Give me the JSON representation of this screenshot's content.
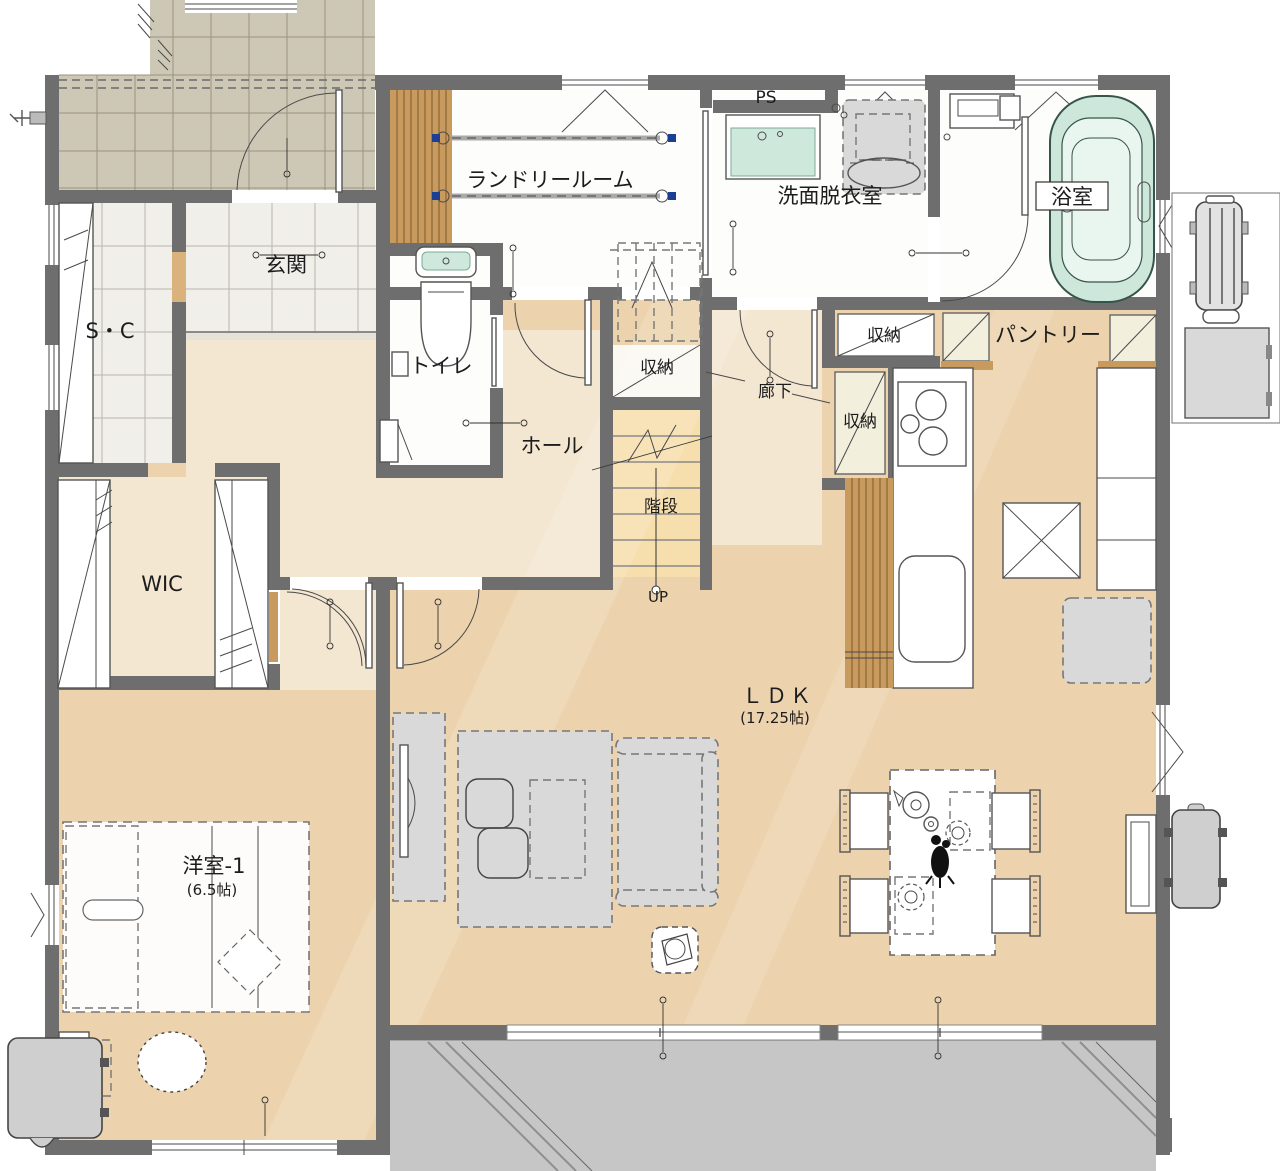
{
  "plan": {
    "type": "floor_plan_1f",
    "rooms": {
      "laundry": "ランドリールーム",
      "pipe_space": "PS",
      "washroom": "洗面脱衣室",
      "bathroom": "浴室",
      "entrance": "玄関",
      "shoe_closet": "S・C",
      "toilet": "トイレ",
      "storage_stairs": "収納",
      "storage_upper": "収納",
      "storage_corridor": "収納",
      "corridor": "廊下",
      "pantry": "パントリー",
      "hall": "ホール",
      "stairs": "階段",
      "stairs_direction": "UP",
      "wic": "WIC",
      "ldk": "ＬＤＫ",
      "ldk_size": "(17.25帖)",
      "bedroom1": "洋室-1",
      "bedroom1_size": "(6.5帖)"
    },
    "colors": {
      "wall": "#6e6e6e",
      "wood_floor": "#ecd3ad",
      "hall_floor": "#f4e7d2",
      "porch_tile": "#cdc7b6",
      "entrance_tile": "#f1efe9",
      "bath_green": "#cde8da",
      "stair_tread": "#f7dfad",
      "terrace_gray": "#c6c6c6",
      "wood_slat": "#c89a5e",
      "furniture_gray": "#d9d9d9"
    }
  }
}
